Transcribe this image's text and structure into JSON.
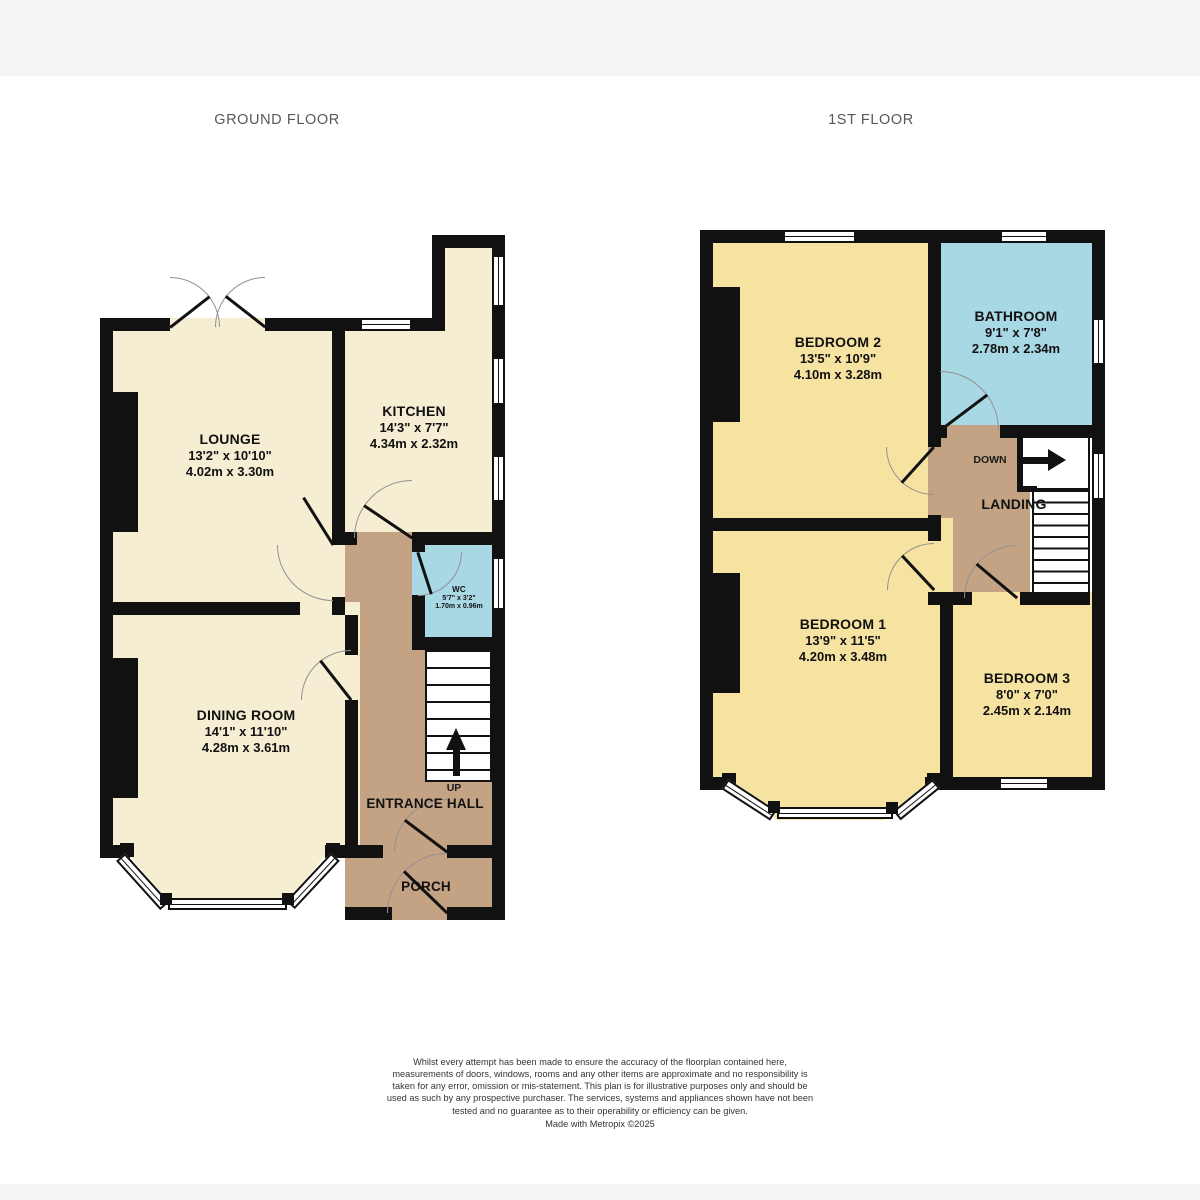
{
  "titles": {
    "ground_floor": "GROUND FLOOR",
    "first_floor": "1ST FLOOR"
  },
  "rooms": {
    "lounge": {
      "name": "LOUNGE",
      "imperial": "13'2\"  x 10'10\"",
      "metric": "4.02m  x 3.30m"
    },
    "kitchen": {
      "name": "KITCHEN",
      "imperial": "14'3\"  x 7'7\"",
      "metric": "4.34m  x 2.32m"
    },
    "wc": {
      "name": "WC",
      "imperial": "5'7\"  x 3'2\"",
      "metric": "1.70m  x 0.96m"
    },
    "dining": {
      "name": "DINING ROOM",
      "imperial": "14'1\"  x 11'10\"",
      "metric": "4.28m  x 3.61m"
    },
    "entrance_hall": {
      "name": "ENTRANCE HALL",
      "direction": "UP"
    },
    "porch": {
      "name": "PORCH"
    },
    "bedroom2": {
      "name": "BEDROOM 2",
      "imperial": "13'5\"  x 10'9\"",
      "metric": "4.10m  x 3.28m"
    },
    "bathroom": {
      "name": "BATHROOM",
      "imperial": "9'1\"  x 7'8\"",
      "metric": "2.78m  x 2.34m"
    },
    "landing": {
      "name": "LANDING",
      "direction": "DOWN"
    },
    "bedroom1": {
      "name": "BEDROOM 1",
      "imperial": "13'9\"  x 11'5\"",
      "metric": "4.20m  x 3.48m"
    },
    "bedroom3": {
      "name": "BEDROOM 3",
      "imperial": "8'0\"  x 7'0\"",
      "metric": "2.45m  x 2.14m"
    }
  },
  "colors": {
    "wall": "#111111",
    "ground_room": "#f6eed3",
    "bedroom": "#f7e3a1",
    "bathroom": "#a9d8e5",
    "hallway": "#c4a284"
  },
  "footer": {
    "disclaimer": "Whilst every attempt has been made to ensure the accuracy of the floorplan contained here, measurements of doors, windows, rooms and any other items are approximate and no responsibility is taken for any error, omission or mis-statement. This plan is for illustrative purposes only and should be used as such by any prospective purchaser. The services, systems and appliances shown have not been tested and no guarantee as to their operability or efficiency can be given.",
    "credit": "Made with Metropix ©2025"
  }
}
